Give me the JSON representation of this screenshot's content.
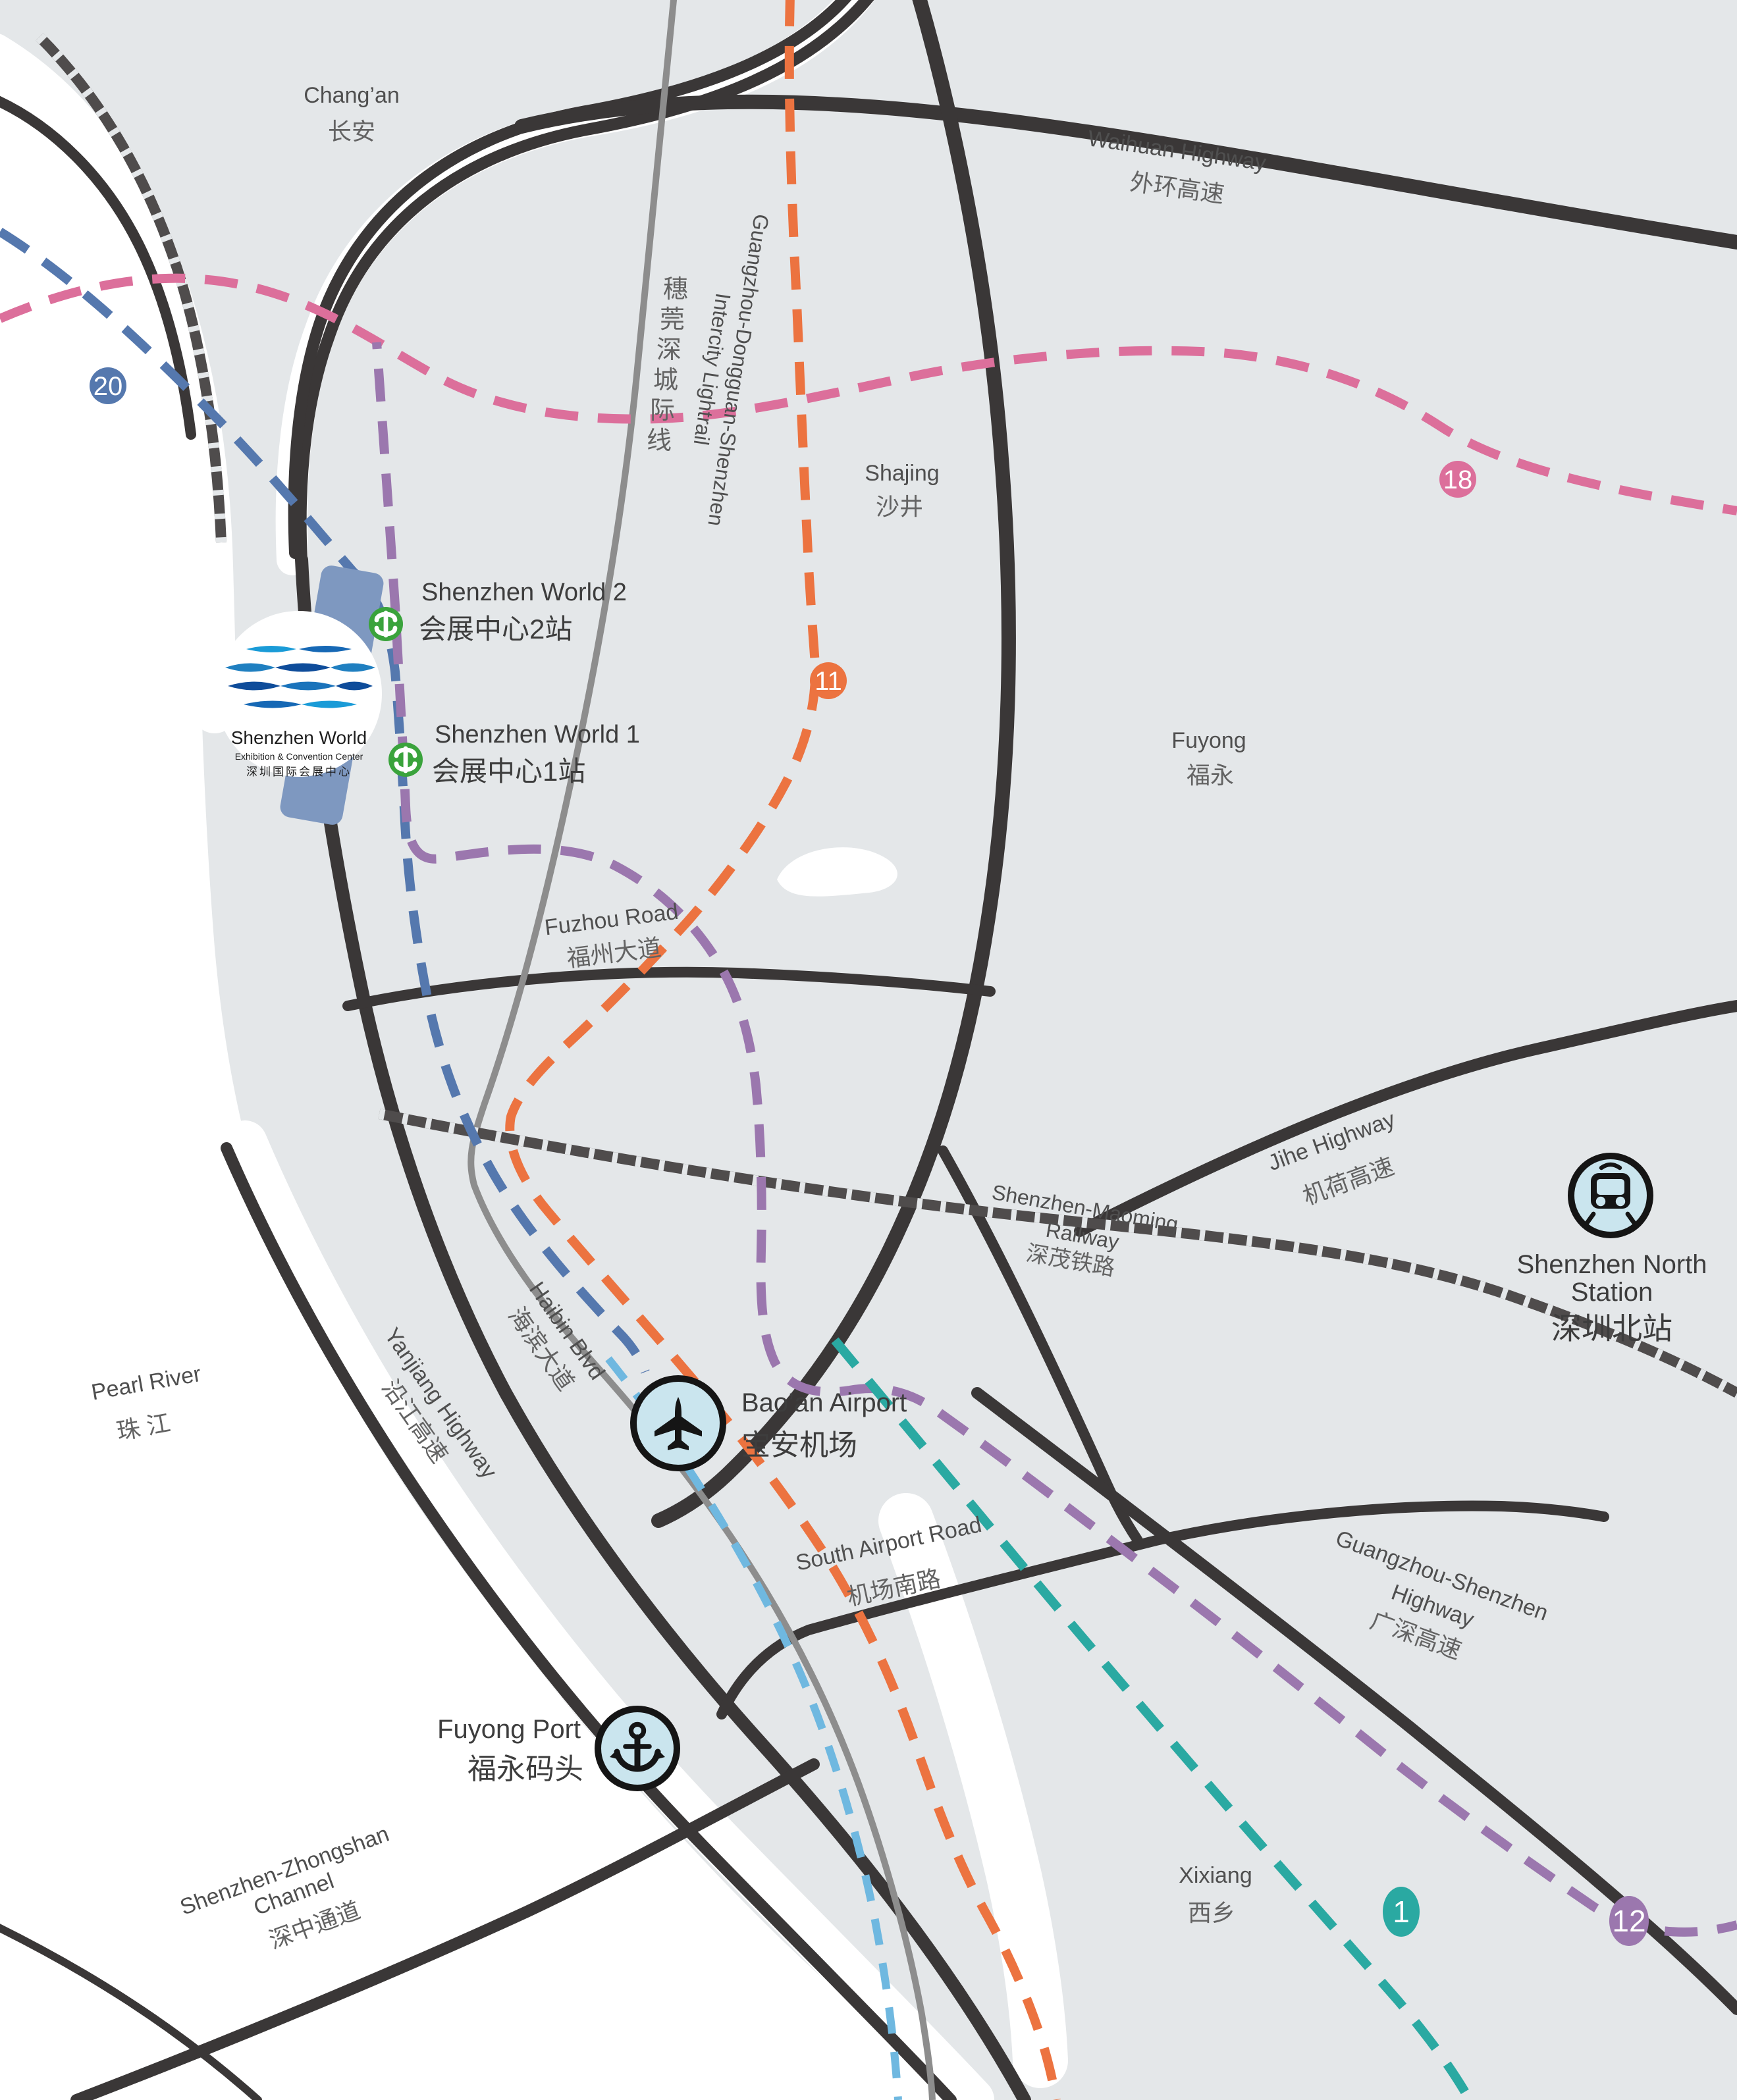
{
  "map": {
    "colors": {
      "land": "#e4e7e9",
      "water": "#ffffff",
      "road": "#3a3737",
      "lightrail_gray": "#8d8d8d",
      "railway": "#4f4c4c",
      "line1": "#2aa9a2",
      "line11": "#ec7340",
      "line12": "#9b77ae",
      "line18": "#dc6f9b",
      "line20": "#5578ae",
      "airport_link": "#6fb8e0",
      "station_green": "#3aa33c",
      "poi_icon_bg": "#cae5ee",
      "venue_building": "#7e98c0"
    },
    "regions": {
      "changan": {
        "en": "Chang’an",
        "zh": "长安"
      },
      "shajing": {
        "en": "Shajing",
        "zh": "沙井"
      },
      "fuyong": {
        "en": "Fuyong",
        "zh": "福永"
      },
      "xixiang": {
        "en": "Xixiang",
        "zh": "西乡"
      },
      "pearl_river": {
        "en": "Pearl River",
        "zh": "珠 江"
      }
    },
    "roads": {
      "waihuan": {
        "en": "Waihuan Highway",
        "zh": "外环高速"
      },
      "jihe": {
        "en": "Jihe Highway",
        "zh": "机荷高速"
      },
      "yanjiang": {
        "en": "Yanjiang Highway",
        "zh": "沿江高速"
      },
      "haibin": {
        "en": "Haibin Blvd",
        "zh": "海滨大道"
      },
      "fuzhou": {
        "en": "Fuzhou Road",
        "zh": "福州大道"
      },
      "south_airport": {
        "en": "South Airport Road",
        "zh": "机场南路"
      },
      "guangshen": {
        "en_line1": "Guangzhou-Shenzhen",
        "en_line2": "Highway",
        "zh": "广深高速"
      },
      "channel": {
        "en_line1": "Shenzhen-Zhongshan",
        "en_line2": "Channel",
        "zh": "深中通道"
      }
    },
    "railways": {
      "maoming": {
        "en_line1": "Shenzhen-Maoming",
        "en_line2": "Railway",
        "zh": "深茂铁路"
      },
      "lightrail": {
        "en_line1": "Guangzhou-Dongguan-Shenzhen",
        "en_line2": "Intercity Lightrail",
        "zh": "穗莞深城际线"
      }
    },
    "stations": {
      "world2": {
        "en": "Shenzhen World 2",
        "zh": "会展中心2站"
      },
      "world1": {
        "en": "Shenzhen World 1",
        "zh": "会展中心1站"
      },
      "north": {
        "en_line1": "Shenzhen North",
        "en_line2": "Station",
        "zh": "深圳北站"
      }
    },
    "pois": {
      "airport": {
        "en": "Bao’an Airport",
        "zh": "宝安机场"
      },
      "port": {
        "en": "Fuyong Port",
        "zh": "福永码头"
      }
    },
    "venue": {
      "name": "Shenzhen World",
      "subtitle": "Exhibition & Convention Center",
      "zh": "深圳国际会展中心"
    },
    "badges": {
      "b20": {
        "num": "20",
        "color": "#5578ae"
      },
      "b18": {
        "num": "18",
        "color": "#dc6f9b"
      },
      "b11": {
        "num": "11",
        "color": "#ec7340"
      },
      "b1": {
        "num": "1",
        "color": "#2aa9a2"
      },
      "b12": {
        "num": "12",
        "color": "#9b77ae"
      }
    }
  }
}
